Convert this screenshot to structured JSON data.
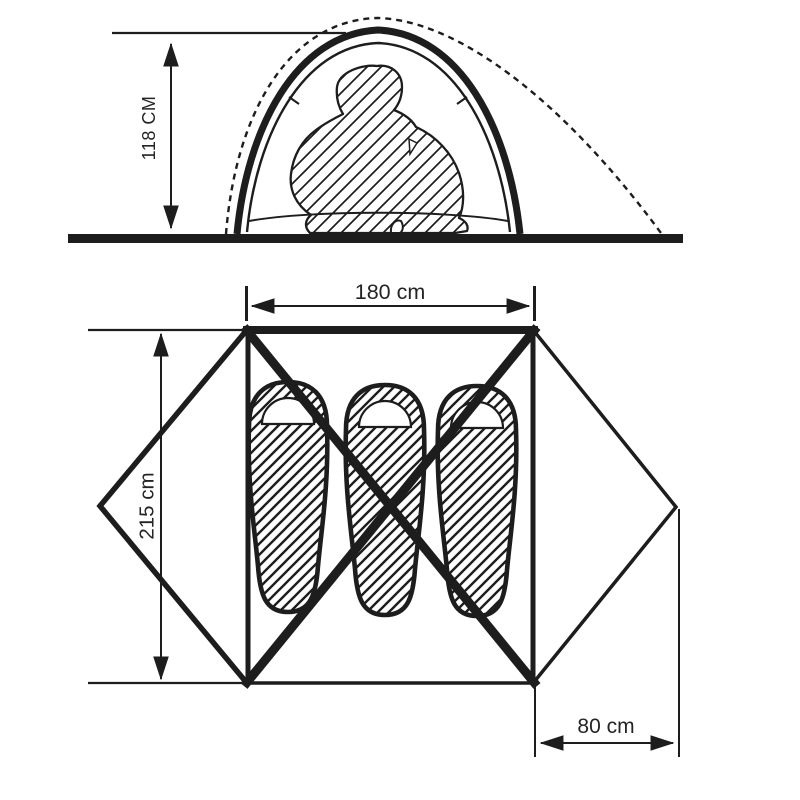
{
  "diagram": {
    "title": "Tent dimensions diagram",
    "side_view": {
      "name": "side-elevation",
      "height_dimension": "118 CM",
      "figure": "seated-person-silhouette"
    },
    "floor_plan": {
      "name": "top-view-floor-plan",
      "width_dimension": "180 cm",
      "length_dimension": "215 cm",
      "vestibule_dimension": "80 cm",
      "sleeping_bag_count": 3
    },
    "colors": {
      "ink": "#1d1d1d",
      "background": "#ffffff"
    }
  }
}
